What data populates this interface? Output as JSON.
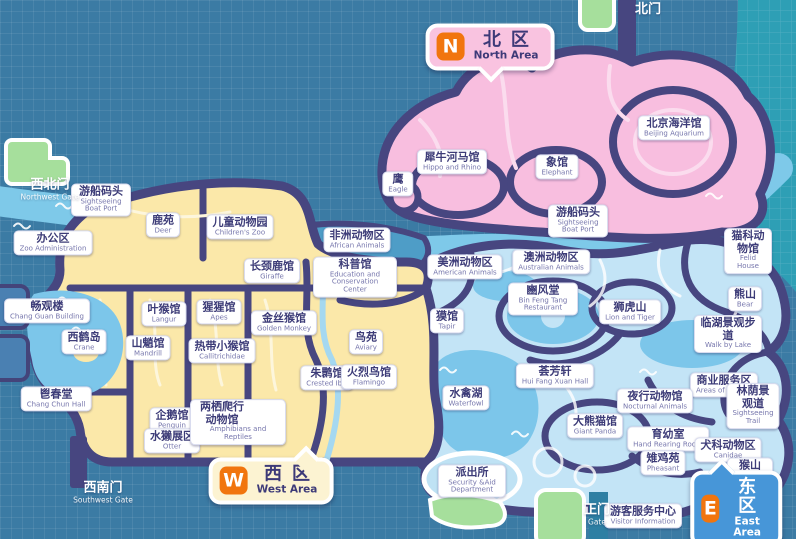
{
  "map": {
    "badges": {
      "north": {
        "letter": "N",
        "zh": "北区",
        "en": "North Area"
      },
      "west": {
        "letter": "W",
        "zh": "西区",
        "en": "West Area"
      },
      "east": {
        "letter": "E",
        "zh": "东区",
        "en": "East Area"
      }
    },
    "gates": [
      {
        "id": "north-gate",
        "zh": "北门",
        "en": "",
        "x": 648,
        "y": 10
      },
      {
        "id": "northwest-gate",
        "zh": "西北门",
        "en": "Northwest Gate",
        "x": 50,
        "y": 190
      },
      {
        "id": "southwest-gate",
        "zh": "西南门",
        "en": "Southwest Gate",
        "x": 103,
        "y": 493
      },
      {
        "id": "main-gate",
        "zh": "正门",
        "en": "Gate",
        "x": 597,
        "y": 515
      }
    ],
    "pois": [
      {
        "id": "beijing-aquarium",
        "zh": "北京海洋馆",
        "en": "Beijing Aquarium",
        "x": 674,
        "y": 128
      },
      {
        "id": "hippo-rhino",
        "zh": "犀牛河马馆",
        "en": "Hippo and Rhino",
        "x": 452,
        "y": 162
      },
      {
        "id": "eagle",
        "zh": "鹰",
        "en": "Eagle",
        "x": 398,
        "y": 184
      },
      {
        "id": "elephant",
        "zh": "象馆",
        "en": "Elephant",
        "x": 557,
        "y": 167
      },
      {
        "id": "boat-port-west",
        "zh": "游船码头",
        "en": "Sightseeing Boat Port",
        "x": 101,
        "y": 200,
        "ew": 48
      },
      {
        "id": "deer",
        "zh": "鹿苑",
        "en": "Deer",
        "x": 163,
        "y": 225
      },
      {
        "id": "childrens-zoo",
        "zh": "儿童动物园",
        "en": "Children's Zoo",
        "x": 240,
        "y": 227
      },
      {
        "id": "zoo-administration",
        "zh": "办公区",
        "en": "Zoo Administration",
        "x": 53,
        "y": 243
      },
      {
        "id": "african-animals",
        "zh": "非洲动物区",
        "en": "African Animals",
        "x": 357,
        "y": 240
      },
      {
        "id": "education-center",
        "zh": "科普馆",
        "en": "Education and Conservation Center",
        "x": 355,
        "y": 277,
        "ew": 72
      },
      {
        "id": "american-animals",
        "zh": "美洲动物区",
        "en": "American Animals",
        "x": 465,
        "y": 267
      },
      {
        "id": "giraffe",
        "zh": "长颈鹿馆",
        "en": "Giraffe",
        "x": 272,
        "y": 271
      },
      {
        "id": "boat-port-east",
        "zh": "游船码头",
        "en": "Sightseeing Boat Port",
        "x": 578,
        "y": 221,
        "ew": 48
      },
      {
        "id": "australian-animals",
        "zh": "澳洲动物区",
        "en": "Australian Animals",
        "x": 551,
        "y": 262
      },
      {
        "id": "felid-house",
        "zh": "猫科动物馆",
        "en": "Felid House",
        "x": 748,
        "y": 251
      },
      {
        "id": "bin-feng-tang",
        "zh": "豳风堂",
        "en": "Bin Feng Tang Restaurant",
        "x": 543,
        "y": 299,
        "ew": 58
      },
      {
        "id": "lion-tiger",
        "zh": "狮虎山",
        "en": "Lion and Tiger",
        "x": 630,
        "y": 312
      },
      {
        "id": "bear",
        "zh": "熊山",
        "en": "Bear",
        "x": 745,
        "y": 299
      },
      {
        "id": "chang-guan-building",
        "zh": "畅观楼",
        "en": "Chang Guan Building",
        "x": 47,
        "y": 311
      },
      {
        "id": "crane-island",
        "zh": "西鹤岛",
        "en": "Crane",
        "x": 84,
        "y": 342
      },
      {
        "id": "langur",
        "zh": "叶猴馆",
        "en": "Langur",
        "x": 164,
        "y": 314
      },
      {
        "id": "mandrill",
        "zh": "山魈馆",
        "en": "Mandrill",
        "x": 148,
        "y": 348
      },
      {
        "id": "apes",
        "zh": "猩猩馆",
        "en": "Apes",
        "x": 219,
        "y": 312
      },
      {
        "id": "callitrichidae",
        "zh": "热带小猴馆",
        "en": "Callitrichidae",
        "x": 222,
        "y": 351
      },
      {
        "id": "golden-monkey",
        "zh": "金丝猴馆",
        "en": "Golden Monkey",
        "x": 284,
        "y": 323
      },
      {
        "id": "aviary",
        "zh": "鸟苑",
        "en": "Aviary",
        "x": 366,
        "y": 342
      },
      {
        "id": "crested-ibis",
        "zh": "朱鹮馆",
        "en": "Crested Ibis",
        "x": 327,
        "y": 378
      },
      {
        "id": "flamingo",
        "zh": "火烈鸟馆",
        "en": "Flamingo",
        "x": 369,
        "y": 377
      },
      {
        "id": "tapir",
        "zh": "獏馆",
        "en": "Tapir",
        "x": 447,
        "y": 321
      },
      {
        "id": "walk-by-lake",
        "zh": "临湖景观步道",
        "en": "Walk by Lake",
        "x": 728,
        "y": 334
      },
      {
        "id": "areas-of-service",
        "zh": "商业服务区",
        "en": "Areas of service",
        "x": 724,
        "y": 385
      },
      {
        "id": "sightseeing-trail",
        "zh": "林荫景观道",
        "en": "Sightseeing Trail",
        "x": 753,
        "y": 406
      },
      {
        "id": "chang-chun-hall",
        "zh": "鬯春堂",
        "en": "Chang Chun Hall",
        "x": 56,
        "y": 399
      },
      {
        "id": "penguin",
        "zh": "企鹅馆",
        "en": "Penguin",
        "x": 172,
        "y": 420
      },
      {
        "id": "otter",
        "zh": "水獭展区",
        "en": "Otter",
        "x": 172,
        "y": 441
      },
      {
        "id": "amphibians-reptiles",
        "zh": "两栖爬行动物馆",
        "en": "Amphibians and Reptiles",
        "x": 238,
        "y": 422,
        "zw": 52
      },
      {
        "id": "waterfowl-lake",
        "zh": "水禽湖",
        "en": "Waterfowl",
        "x": 466,
        "y": 398
      },
      {
        "id": "hui-fang-xuan",
        "zh": "荟芳轩",
        "en": "Hui Fang Xuan Hall",
        "x": 555,
        "y": 376
      },
      {
        "id": "giant-panda",
        "zh": "大熊猫馆",
        "en": "Giant Panda",
        "x": 595,
        "y": 426
      },
      {
        "id": "nocturnal-animals",
        "zh": "夜行动物馆",
        "en": "Nocturnal Animals",
        "x": 655,
        "y": 401
      },
      {
        "id": "hand-rearing-room",
        "zh": "育幼室",
        "en": "Hand Rearing Room",
        "x": 668,
        "y": 439
      },
      {
        "id": "pheasant",
        "zh": "雉鸡苑",
        "en": "Pheasant",
        "x": 663,
        "y": 463
      },
      {
        "id": "canidae",
        "zh": "犬科动物区",
        "en": "Canidae",
        "x": 728,
        "y": 450
      },
      {
        "id": "monkey-hill",
        "zh": "猴山",
        "en": "Monkey Hill",
        "x": 750,
        "y": 474
      },
      {
        "id": "security-department",
        "zh": "派出所",
        "en": "Security &Aid Department",
        "x": 472,
        "y": 481,
        "ew": 56
      },
      {
        "id": "visitor-information",
        "zh": "游客服务中心",
        "en": "Visitor Information",
        "x": 643,
        "y": 516
      }
    ],
    "colors": {
      "background": "#3B7BA4",
      "north_area_pink": "#F8BEDF",
      "west_area_yellow": "#FBE8A9",
      "east_area_blue": "#C3E4F6",
      "water": "#7CC6EA",
      "river": "#7EC9E9",
      "road_navy": "#474680",
      "teal_corner": "#2E9FB5",
      "gate_green": "#A6DF9C",
      "badge_orange": "#F1750E",
      "label_text": "#3D3C78"
    }
  }
}
